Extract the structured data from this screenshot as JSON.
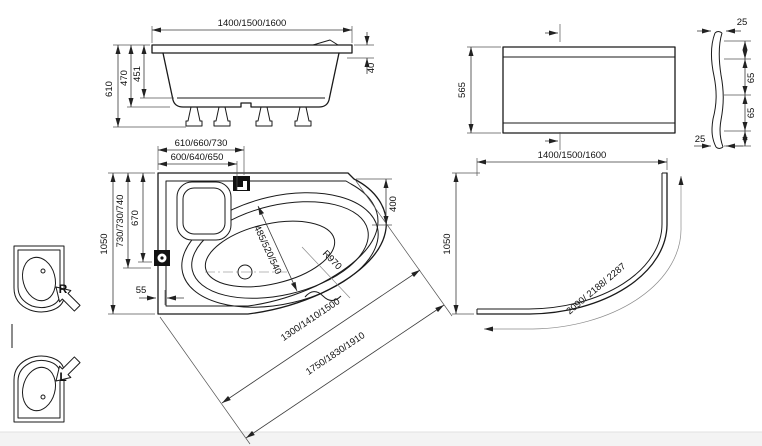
{
  "side_view": {
    "width": "1400/1500/1600",
    "height_total": "610",
    "height_shell": "470",
    "depth_inner": "451",
    "rim_drop": "40"
  },
  "front_panel": {
    "height": "565",
    "thickness_top": "25",
    "flange_upper": "65",
    "flange_lower": "65",
    "thickness_bottom": "25"
  },
  "plan_view": {
    "faucet_offset_outer": "610/660/730",
    "faucet_offset_inner": "600/640/650",
    "depth_total": "1050",
    "fitting_offset_outer": "730/730/740",
    "fitting_offset_inner": "670",
    "wall_to_rim": "55",
    "corner_drop": "400",
    "bowl_width": "485/520/540",
    "front_radius": "R970",
    "front_chord_inner": "1300/1410/1500",
    "front_chord_outer": "1750/1830/1910"
  },
  "corner_panel": {
    "width": "1400/1500/1600",
    "depth": "1050",
    "arc_length": "2090/ 2188/ 2287"
  },
  "orientation": {
    "right": "R",
    "left": "L"
  }
}
